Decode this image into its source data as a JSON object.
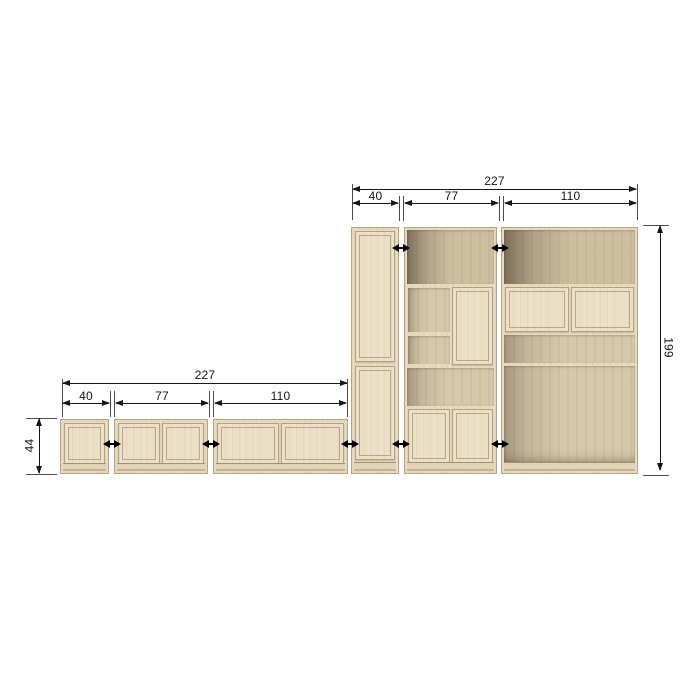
{
  "diagram": {
    "kind": "furniture-dimension-drawing",
    "background": "#ffffff",
    "line_color": "#161616",
    "connector_icon": "double-headed-arrow",
    "wood_colors": {
      "door_face": "#ebdfc6",
      "frame": "#e7d9bc",
      "interior": "#d6c8ab",
      "interior_dark": "#cdbe9f",
      "edge": "#b5a383"
    }
  },
  "dims": {
    "tall": {
      "total": "227",
      "segments": [
        "40",
        "77",
        "110"
      ],
      "height": "199"
    },
    "low": {
      "total": "227",
      "segments": [
        "40",
        "77",
        "110"
      ],
      "height": "44"
    }
  }
}
